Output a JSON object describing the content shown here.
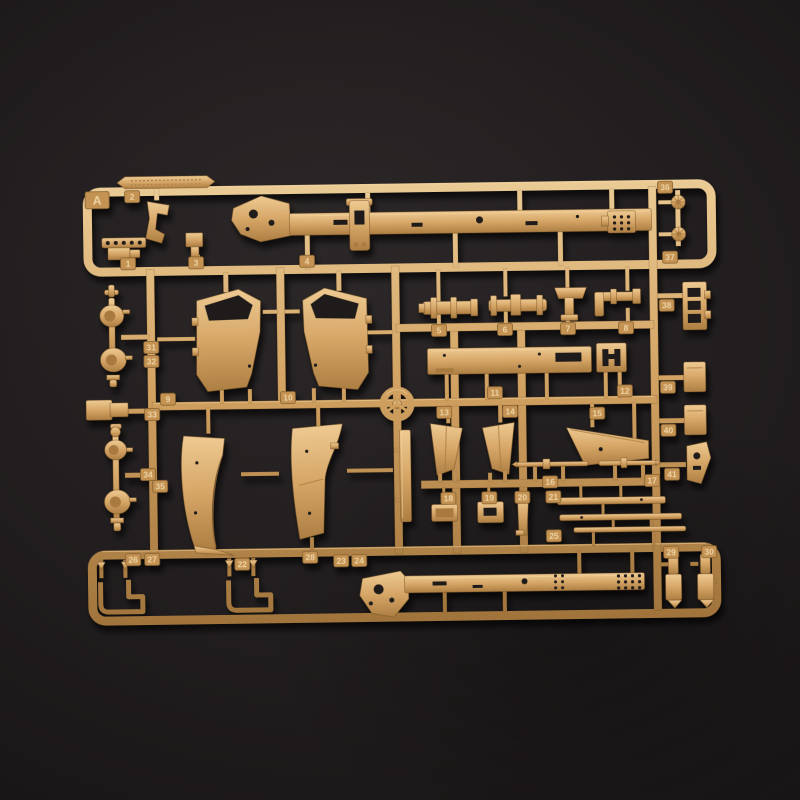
{
  "scene": {
    "description": "Sand-colored injection-molded plastic model kit sprue (parts runner A) photographed on a dark charcoal background",
    "background_color": "#1e1b1c",
    "vignette_color": "#131011",
    "plastic_base": "#d7a768",
    "plastic_highlight": "#f0d29c",
    "plastic_shadow": "#9c7038",
    "plastic_outline": "#6e4a20",
    "tag_fill": "#c49252",
    "tag_stroke": "#84602f",
    "tag_text": "#f2dcae"
  },
  "sprue": {
    "runner_letter": "A",
    "letter_tag": {
      "label": "A",
      "x": 100,
      "y": 196,
      "w": 24,
      "h": 17
    },
    "part_tags": [
      {
        "label": "1",
        "x": 130,
        "y": 260
      },
      {
        "label": "2",
        "x": 135,
        "y": 193
      },
      {
        "label": "3",
        "x": 198,
        "y": 260
      },
      {
        "label": "4",
        "x": 309,
        "y": 260
      },
      {
        "label": "5",
        "x": 440,
        "y": 331
      },
      {
        "label": "6",
        "x": 506,
        "y": 331
      },
      {
        "label": "7",
        "x": 569,
        "y": 331
      },
      {
        "label": "8",
        "x": 627,
        "y": 331
      },
      {
        "label": "9",
        "x": 168,
        "y": 396
      },
      {
        "label": "10",
        "x": 288,
        "y": 396
      },
      {
        "label": "11",
        "x": 495,
        "y": 394
      },
      {
        "label": "12",
        "x": 625,
        "y": 394
      },
      {
        "label": "13",
        "x": 444,
        "y": 413
      },
      {
        "label": "14",
        "x": 510,
        "y": 413
      },
      {
        "label": "15",
        "x": 597,
        "y": 416
      },
      {
        "label": "16",
        "x": 549,
        "y": 484
      },
      {
        "label": "17",
        "x": 651,
        "y": 484
      },
      {
        "label": "18",
        "x": 447,
        "y": 499
      },
      {
        "label": "19",
        "x": 488,
        "y": 499
      },
      {
        "label": "20",
        "x": 521,
        "y": 499
      },
      {
        "label": "21",
        "x": 552,
        "y": 499
      },
      {
        "label": "22",
        "x": 240,
        "y": 562
      },
      {
        "label": "23",
        "x": 339,
        "y": 560
      },
      {
        "label": "24",
        "x": 357,
        "y": 560
      },
      {
        "label": "25",
        "x": 552,
        "y": 538
      },
      {
        "label": "26",
        "x": 131,
        "y": 556
      },
      {
        "label": "27",
        "x": 150,
        "y": 556
      },
      {
        "label": "28",
        "x": 308,
        "y": 556
      },
      {
        "label": "29",
        "x": 669,
        "y": 556
      },
      {
        "label": "30",
        "x": 707,
        "y": 556
      },
      {
        "label": "31",
        "x": 152,
        "y": 344
      },
      {
        "label": "32",
        "x": 152,
        "y": 358
      },
      {
        "label": "33",
        "x": 152,
        "y": 411
      },
      {
        "label": "34",
        "x": 147,
        "y": 471
      },
      {
        "label": "35",
        "x": 159,
        "y": 483
      },
      {
        "label": "36",
        "x": 668,
        "y": 191
      },
      {
        "label": "37",
        "x": 672,
        "y": 261
      },
      {
        "label": "38",
        "x": 668,
        "y": 309
      },
      {
        "label": "39",
        "x": 668,
        "y": 391
      },
      {
        "label": "40",
        "x": 668,
        "y": 434
      },
      {
        "label": "41",
        "x": 671,
        "y": 478
      }
    ],
    "parts": [
      {
        "tag": "A",
        "name": "runner-letter-plate"
      },
      {
        "tag": "1",
        "name": "drilled-strip-bracket"
      },
      {
        "tag": "2",
        "name": "small-lever"
      },
      {
        "tag": "3",
        "name": "t-post-mount"
      },
      {
        "tag": "4",
        "name": "chassis-frame-rail-upper"
      },
      {
        "tag": "5",
        "name": "axle-cylinder"
      },
      {
        "tag": "6",
        "name": "driveshaft-cylinder"
      },
      {
        "tag": "7",
        "name": "engine-mount"
      },
      {
        "tag": "8",
        "name": "elbow-fitting"
      },
      {
        "tag": "9",
        "name": "cab-door-left"
      },
      {
        "tag": "10",
        "name": "cab-door-right"
      },
      {
        "tag": "11",
        "name": "side-sill-panel"
      },
      {
        "tag": "12",
        "name": "slotted-box-plate"
      },
      {
        "tag": "13",
        "name": "mud-flap-bracket-left"
      },
      {
        "tag": "14",
        "name": "mud-flap-bracket-right"
      },
      {
        "tag": "15",
        "name": "wedge-panel"
      },
      {
        "tag": "16",
        "name": "tie-rod-short"
      },
      {
        "tag": "17",
        "name": "tie-rod-long"
      },
      {
        "tag": "18",
        "name": "hatch-plate"
      },
      {
        "tag": "19",
        "name": "slotted-plate"
      },
      {
        "tag": "20",
        "name": "shift-lever"
      },
      {
        "tag": "21",
        "name": "frame-bar-upper"
      },
      {
        "tag": "22",
        "name": "fender-left"
      },
      {
        "tag": "23",
        "name": "fender-right"
      },
      {
        "tag": "24",
        "name": "side-plank"
      },
      {
        "tag": "25",
        "name": "frame-bar-lower"
      },
      {
        "tag": "26",
        "name": "towing-hook-left"
      },
      {
        "tag": "27",
        "name": "towing-hook-right"
      },
      {
        "tag": "28",
        "name": "chassis-frame-rail-lower"
      },
      {
        "tag": "29",
        "name": "shackle-pin-left"
      },
      {
        "tag": "30",
        "name": "shackle-pin-right"
      },
      {
        "tag": "31",
        "name": "axle-housing-upper-a"
      },
      {
        "tag": "32",
        "name": "axle-housing-upper-b"
      },
      {
        "tag": "33",
        "name": "gearbox-block"
      },
      {
        "tag": "34",
        "name": "axle-housing-lower-a"
      },
      {
        "tag": "35",
        "name": "axle-housing-lower-b"
      },
      {
        "tag": "36",
        "name": "sprocket-small-upper"
      },
      {
        "tag": "37",
        "name": "sprocket-small-lower"
      },
      {
        "tag": "38",
        "name": "ladder-bracket"
      },
      {
        "tag": "39",
        "name": "stowage-box-upper"
      },
      {
        "tag": "40",
        "name": "stowage-box-lower"
      },
      {
        "tag": "41",
        "name": "angled-bracket"
      },
      {
        "tag": "",
        "name": "steering-wheel"
      },
      {
        "tag": "",
        "name": "embossed-brand-strip"
      }
    ]
  }
}
